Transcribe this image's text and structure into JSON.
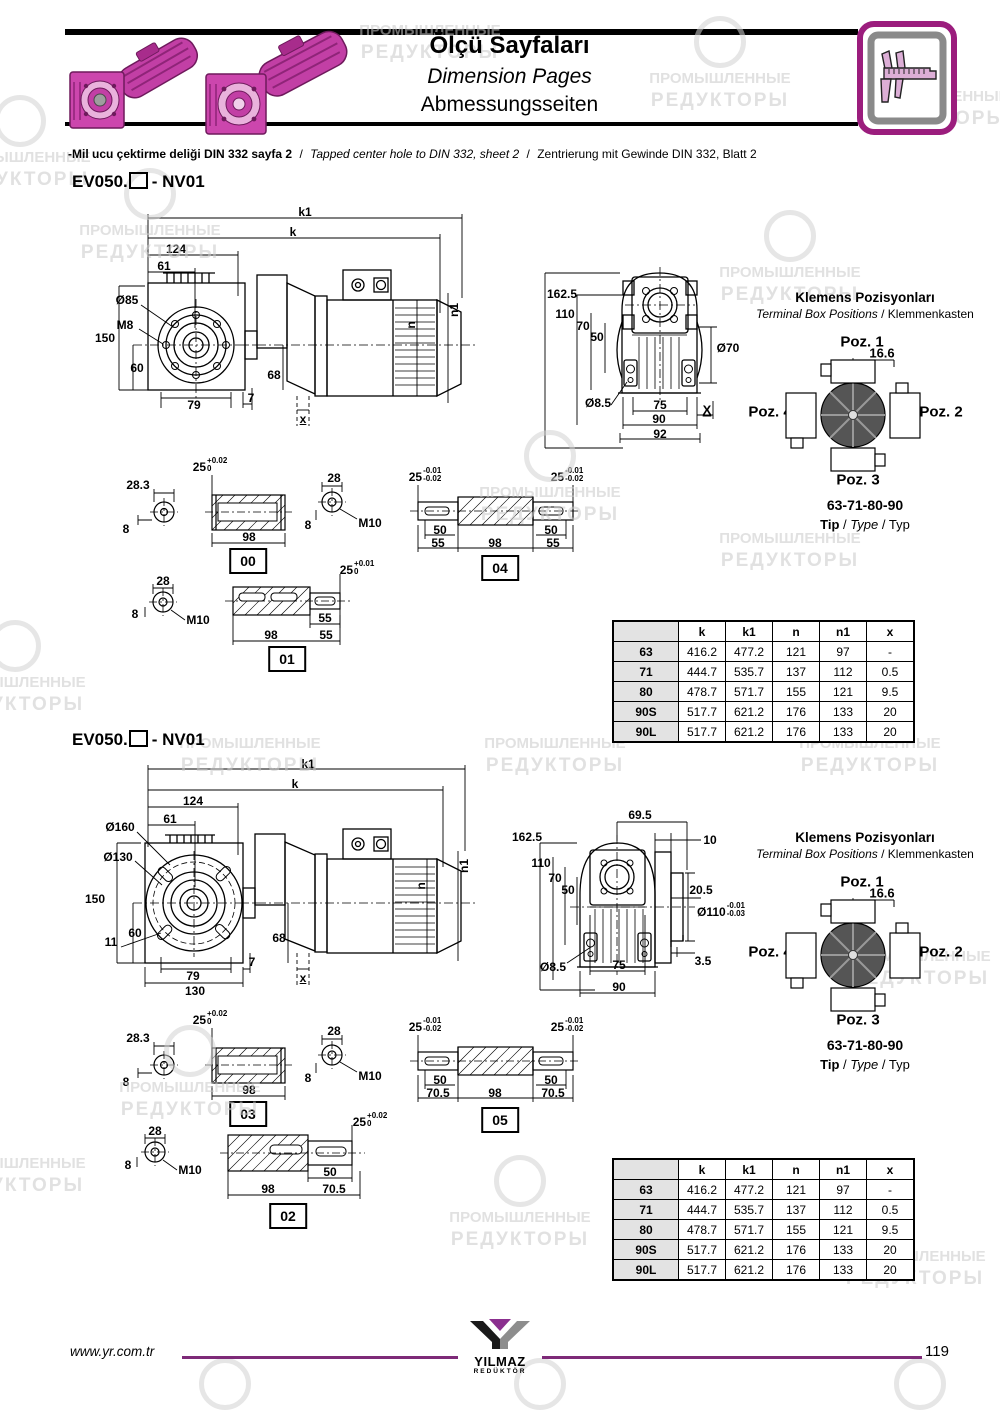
{
  "colors": {
    "brand_purple": "#8b2f8f",
    "product_pink": "#c23fa5",
    "table_row_gray": "#e3e3e3"
  },
  "icons": {
    "header": "caliper-icon",
    "footer": "yilmaz-y-logo"
  },
  "wm": {
    "l1": "ПРОМЫШЛЕННЫЕ",
    "l2": "РЕДУКТОРЫ"
  },
  "hdr": {
    "title_tr": "Ölçü Sayfaları",
    "title_en": "Dimension Pages",
    "title_de": "Abmessungsseiten"
  },
  "note": {
    "tr": "-Mil ucu çektirme deliği DIN 332 sayfa 2",
    "sep": "/",
    "en": "Tapped center hole to DIN 332, sheet 2",
    "de": "Zentrierung mit Gewinde DIN 332, Blatt 2"
  },
  "model": {
    "prefix": "EV050.",
    "suffix": "- NV01"
  },
  "s1_side": {
    "k1": "k1",
    "k": "k",
    "d124": "124",
    "d61": "61",
    "dia85": "Ø85",
    "m8": "M8",
    "d150": "150",
    "d60": "60",
    "d79": "79",
    "d7": "7",
    "d68": "68",
    "x": "x",
    "n": "n",
    "n1": "n1"
  },
  "s1_rear": {
    "d1625": "162.5",
    "d110": "110",
    "d70": "70",
    "d50": "50",
    "dia70": "Ø70",
    "dia85": "Ø8.5",
    "d75": "75",
    "d90": "90",
    "d92": "92",
    "x": "X"
  },
  "term": {
    "title_tr": "Klemens Pozisyonları",
    "title_en": "Terminal Box Positions",
    "title_de": "Klemmenkasten",
    "sep": "/",
    "poz1": "Poz. 1",
    "poz2": "Poz. 2",
    "poz3": "Poz. 3",
    "poz4": "Poz. 4",
    "offset": "16.6",
    "sizes": "63-71-80-90",
    "tip_tr": "Tip",
    "tip_en": "Type",
    "tip_de": "Typ"
  },
  "shafts": {
    "s00": {
      "id": "00",
      "d": "28.3",
      "h": "8",
      "tol": "25",
      "tsup": "+0.02",
      "tsub": "0",
      "len": "98"
    },
    "sA": {
      "d": "28",
      "h": "8",
      "m": "M10"
    },
    "s01": {
      "id": "01",
      "tol": "25",
      "tsup": "+0.01",
      "tsub": "0",
      "len": "98",
      "e1": "55",
      "e2": "55"
    },
    "s04": {
      "id": "04",
      "tol": "25",
      "tsup": "-0.01",
      "tsub": "-0.02",
      "key": "50",
      "ext": "55",
      "len": "98"
    },
    "s03": {
      "id": "03",
      "d": "28.3",
      "h": "8",
      "tol": "25",
      "tsup": "+0.02",
      "tsub": "0",
      "len": "98"
    },
    "s05": {
      "id": "05",
      "tol": "25",
      "tsup": "-0.01",
      "tsub": "-0.02",
      "key": "50",
      "ext": "70.5",
      "len": "98"
    },
    "s02": {
      "id": "02",
      "tol": "25",
      "tsup": "+0.02",
      "tsub": "0",
      "key": "50",
      "ext": "70.5",
      "len": "98"
    }
  },
  "s2_side": {
    "k1": "k1",
    "k": "k",
    "d124": "124",
    "d61": "61",
    "dia160": "Ø160",
    "dia130": "Ø130",
    "d150": "150",
    "d60": "60",
    "d11": "11",
    "d79": "79",
    "d7": "7",
    "d130": "130",
    "d68": "68",
    "x": "x",
    "n": "n",
    "n1": "n1"
  },
  "s2_rear": {
    "d695": "69.5",
    "d10": "10",
    "d1625": "162.5",
    "d110": "110",
    "d70": "70",
    "d50": "50",
    "d205": "20.5",
    "dia110": "Ø110",
    "tsup": "-0.01",
    "tsub": "-0.03",
    "d35": "3.5",
    "dia85": "Ø8.5",
    "d75": "75",
    "d90": "90"
  },
  "t1": {
    "headers": [
      "",
      "k",
      "k1",
      "n",
      "n1",
      "x"
    ],
    "rows": [
      [
        "63",
        "416.2",
        "477.2",
        "121",
        "97",
        "-"
      ],
      [
        "71",
        "444.7",
        "535.7",
        "137",
        "112",
        "0.5"
      ],
      [
        "80",
        "478.7",
        "571.7",
        "155",
        "121",
        "9.5"
      ],
      [
        "90S",
        "517.7",
        "621.2",
        "176",
        "133",
        "20"
      ],
      [
        "90L",
        "517.7",
        "621.2",
        "176",
        "133",
        "20"
      ]
    ]
  },
  "t2": {
    "headers": [
      "",
      "k",
      "k1",
      "n",
      "n1",
      "x"
    ],
    "rows": [
      [
        "63",
        "416.2",
        "477.2",
        "121",
        "97",
        "-"
      ],
      [
        "71",
        "444.7",
        "535.7",
        "137",
        "112",
        "0.5"
      ],
      [
        "80",
        "478.7",
        "571.7",
        "155",
        "121",
        "9.5"
      ],
      [
        "90S",
        "517.7",
        "621.2",
        "176",
        "133",
        "20"
      ],
      [
        "90L",
        "517.7",
        "621.2",
        "176",
        "133",
        "20"
      ]
    ]
  },
  "footer": {
    "site": "www.yr.com.tr",
    "brand": "YILMAZ",
    "brand_sub": "REDÜKTÖR",
    "page": "119"
  }
}
